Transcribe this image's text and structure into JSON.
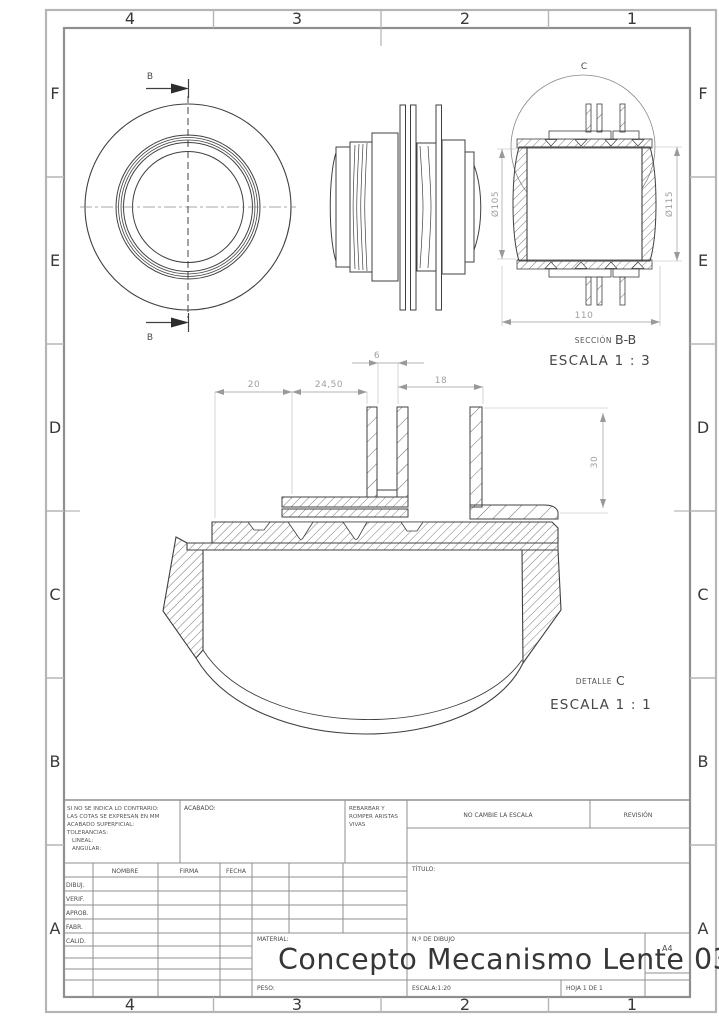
{
  "sheet": {
    "zone_cols": [
      "4",
      "3",
      "2",
      "1"
    ],
    "zone_rows": [
      "F",
      "E",
      "D",
      "C",
      "B",
      "A"
    ],
    "front_view": {
      "cut_label": "B"
    },
    "section_view": {
      "detail_circle_label": "C",
      "caption_prefix": "SECCIÓN",
      "caption_name": "B-B",
      "caption_scale": "ESCALA 1 : 3",
      "dim_dia_inner": "Ø105",
      "dim_dia_outer": "Ø115",
      "dim_width": "110"
    },
    "detail_view": {
      "caption_prefix": "DETALLE",
      "caption_name": "C",
      "caption_scale": "ESCALA 1 : 1",
      "dim_20": "20",
      "dim_24_50": "24,50",
      "dim_6": "6",
      "dim_18": "18",
      "dim_30": "30"
    },
    "title_block": {
      "tolerance_lines": [
        "SI NO SE INDICA LO CONTRARIO:",
        "LAS COTAS SE EXPRESAN EN MM",
        "ACABADO SUPERFICIAL:",
        "TOLERANCIAS:",
        "LINEAL:",
        "ANGULAR:"
      ],
      "acabado_label": "ACABADO:",
      "deburr_lines": [
        "REBARBAR Y",
        "ROMPER ARISTAS",
        "VIVAS"
      ],
      "no_cambie_label": "NO CAMBIE LA ESCALA",
      "revision_label": "REVISIÓN",
      "col_nombre": "NOMBRE",
      "col_firma": "FIRMA",
      "col_fecha": "FECHA",
      "row_labels": [
        "DIBUJ.",
        "VERIF.",
        "APROB.",
        "FABR.",
        "CALID."
      ],
      "titulo_label": "TÍTULO:",
      "material_label": "MATERIAL:",
      "peso_label": "PESO:",
      "num_dibujo_label": "N.º DE DIBUJO",
      "drawing_number": "Concepto Mecanismo Lente 03.",
      "paper_size": "A4",
      "escala_label": "ESCALA:1:20",
      "hoja_label": "HOJA 1 DE 1"
    }
  }
}
